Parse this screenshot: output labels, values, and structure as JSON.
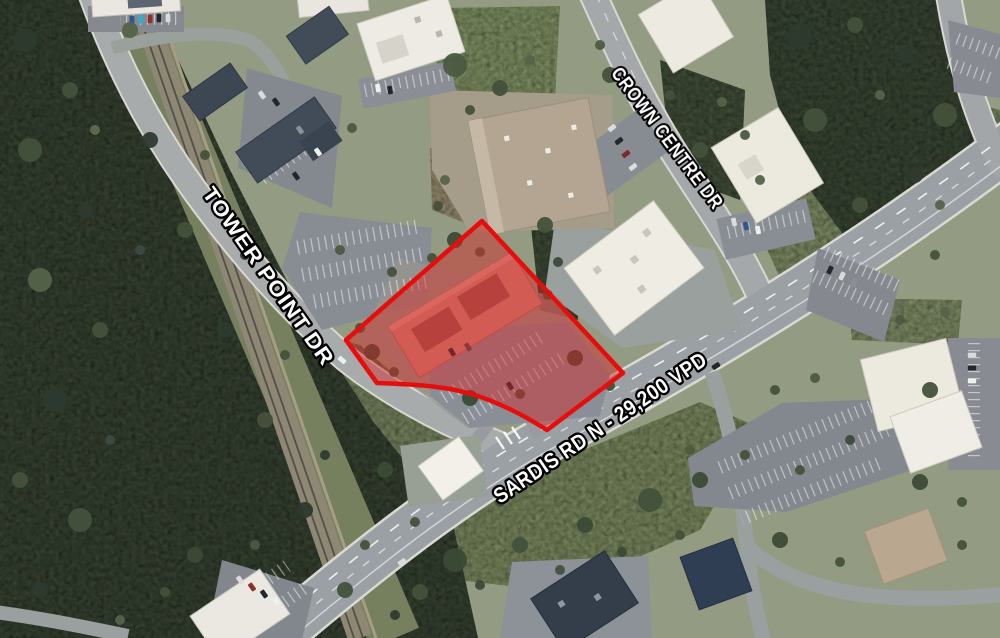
{
  "map": {
    "kind": "aerial-satellite-site-map",
    "road_labels": [
      {
        "id": "tower-point-dr",
        "text": "TOWER POINT DR"
      },
      {
        "id": "crown-centre-dr",
        "text": "CROWN CENTRE DR"
      },
      {
        "id": "sardis-rd-n",
        "text": "SARDIS RD N - 29,200 VPD"
      }
    ],
    "traffic_count": "29,200 VPD",
    "parcel_highlight": {
      "stroke": "#e60d0d",
      "stroke_width": "4.5",
      "fill": "#d62424",
      "fill_opacity": "0.46"
    },
    "label_style": {
      "fill": "#ffffff",
      "outline": "#000000"
    }
  }
}
